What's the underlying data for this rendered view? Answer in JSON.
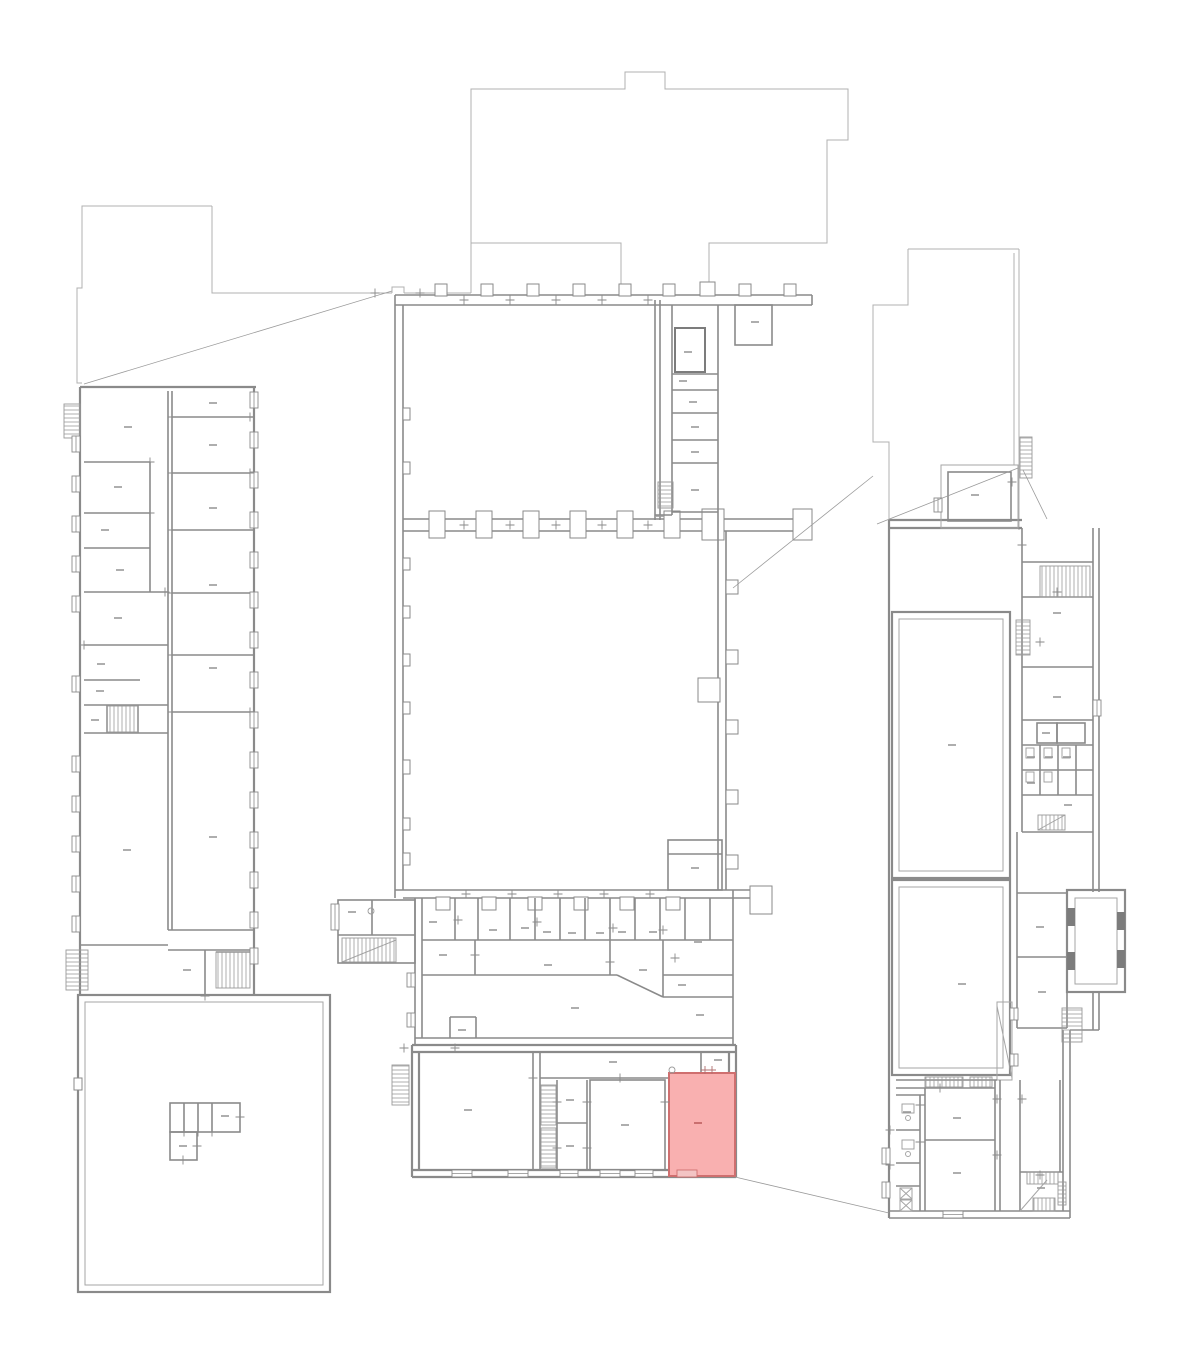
{
  "meta": {
    "drawing_type": "architectural-floor-plan",
    "canvas_width": 1200,
    "canvas_height": 1364
  },
  "palette": {
    "background": "#ffffff",
    "outline_gray": "#b0b0b0",
    "wall_gray": "#8a8a8a",
    "mark_gray": "#9a9a9a",
    "highlight_fill": "#f9b0b0",
    "highlight_stroke": "#cf6f6f",
    "highlight_mark": "#bf5f5f"
  },
  "highlighted_room": {
    "x": 669,
    "y": 1073,
    "width": 66,
    "height": 103,
    "label_mark": {
      "x": 698,
      "y": 1123
    },
    "window": {
      "x": 677,
      "y": 1170,
      "width": 20,
      "height": 7
    }
  },
  "room_label_marks": [
    [
      128,
      427
    ],
    [
      118,
      487
    ],
    [
      105,
      530
    ],
    [
      120,
      570
    ],
    [
      118,
      618
    ],
    [
      101,
      664
    ],
    [
      100,
      691
    ],
    [
      95,
      720
    ],
    [
      127,
      850
    ],
    [
      213,
      403
    ],
    [
      213,
      445
    ],
    [
      213,
      508
    ],
    [
      213,
      585
    ],
    [
      213,
      668
    ],
    [
      213,
      837
    ],
    [
      187,
      970
    ],
    [
      225,
      1116
    ],
    [
      183,
      1146
    ],
    [
      688,
      352
    ],
    [
      683,
      381
    ],
    [
      693,
      402
    ],
    [
      695,
      427
    ],
    [
      695,
      452
    ],
    [
      695,
      490
    ],
    [
      660,
      516
    ],
    [
      755,
      322
    ],
    [
      695,
      868
    ],
    [
      433,
      922
    ],
    [
      493,
      930
    ],
    [
      525,
      928
    ],
    [
      547,
      932
    ],
    [
      572,
      933
    ],
    [
      600,
      933
    ],
    [
      622,
      932
    ],
    [
      653,
      932
    ],
    [
      698,
      942
    ],
    [
      443,
      955
    ],
    [
      548,
      965
    ],
    [
      643,
      970
    ],
    [
      575,
      1008
    ],
    [
      682,
      985
    ],
    [
      700,
      1015
    ],
    [
      462,
      1030
    ],
    [
      352,
      912
    ],
    [
      468,
      1110
    ],
    [
      613,
      1062
    ],
    [
      570,
      1100
    ],
    [
      570,
      1146
    ],
    [
      625,
      1125
    ],
    [
      718,
      1060
    ],
    [
      975,
      495
    ],
    [
      1057,
      613
    ],
    [
      1057,
      697
    ],
    [
      1046,
      733
    ],
    [
      1068,
      805
    ],
    [
      1040,
      927
    ],
    [
      1042,
      992
    ],
    [
      962,
      984
    ],
    [
      952,
      745
    ],
    [
      957,
      1118
    ],
    [
      957,
      1173
    ],
    [
      1041,
      1188
    ],
    [
      907,
      1112
    ],
    [
      1031,
      757
    ],
    [
      1049,
      757
    ],
    [
      1067,
      757
    ],
    [
      1031,
      783
    ]
  ],
  "window_marks_vertical": [
    [
      72,
      436,
      16
    ],
    [
      72,
      476,
      16
    ],
    [
      72,
      516,
      16
    ],
    [
      72,
      556,
      16
    ],
    [
      72,
      596,
      16
    ],
    [
      72,
      676,
      16
    ],
    [
      72,
      756,
      16
    ],
    [
      72,
      796,
      16
    ],
    [
      72,
      836,
      16
    ],
    [
      72,
      876,
      16
    ],
    [
      72,
      916,
      16
    ],
    [
      250,
      392,
      16
    ],
    [
      250,
      432,
      16
    ],
    [
      250,
      472,
      16
    ],
    [
      250,
      512,
      16
    ],
    [
      250,
      552,
      16
    ],
    [
      250,
      592,
      16
    ],
    [
      250,
      632,
      16
    ],
    [
      250,
      672,
      16
    ],
    [
      250,
      712,
      16
    ],
    [
      250,
      752,
      16
    ],
    [
      250,
      792,
      16
    ],
    [
      250,
      832,
      16
    ],
    [
      250,
      872,
      16
    ],
    [
      250,
      912,
      16
    ],
    [
      250,
      948,
      16
    ],
    [
      882,
      1148,
      16
    ],
    [
      882,
      1182,
      16
    ],
    [
      1093,
      700,
      16
    ],
    [
      1010,
      1008,
      12
    ],
    [
      1010,
      1054,
      12
    ],
    [
      331,
      904,
      26
    ],
    [
      407,
      973,
      14
    ],
    [
      407,
      1013,
      14
    ],
    [
      934,
      498,
      14
    ]
  ],
  "window_marks_horizontal": [
    [
      452,
      1170,
      20
    ],
    [
      508,
      1170,
      20
    ],
    [
      560,
      1170,
      18
    ],
    [
      600,
      1170,
      20
    ],
    [
      635,
      1170,
      18
    ],
    [
      943,
      1211,
      20
    ]
  ],
  "stair_hatches": [
    [
      64,
      404,
      16,
      34,
      "h"
    ],
    [
      107,
      706,
      31,
      26,
      "v"
    ],
    [
      66,
      950,
      22,
      40,
      "h"
    ],
    [
      216,
      952,
      34,
      36,
      "v"
    ],
    [
      658,
      482,
      15,
      26,
      "h"
    ],
    [
      342,
      938,
      54,
      24,
      "v"
    ],
    [
      541,
      1085,
      15,
      40,
      "h"
    ],
    [
      541,
      1128,
      15,
      40,
      "h"
    ],
    [
      392,
      1065,
      17,
      40,
      "h"
    ],
    [
      1020,
      437,
      12,
      41,
      "h"
    ],
    [
      1040,
      566,
      50,
      31,
      "v"
    ],
    [
      1016,
      620,
      14,
      35,
      "h"
    ],
    [
      1038,
      815,
      27,
      15,
      "v"
    ],
    [
      1062,
      1008,
      20,
      34,
      "h"
    ],
    [
      925,
      1077,
      38,
      10,
      "v"
    ],
    [
      970,
      1077,
      22,
      10,
      "v"
    ],
    [
      1027,
      1172,
      31,
      12,
      "v"
    ],
    [
      1033,
      1198,
      22,
      13,
      "v"
    ],
    [
      1058,
      1182,
      8,
      23,
      "h"
    ]
  ],
  "door_ticks": [
    [
      375,
      293
    ],
    [
      420,
      293
    ],
    [
      464,
      300
    ],
    [
      510,
      300
    ],
    [
      556,
      300
    ],
    [
      602,
      300
    ],
    [
      648,
      300
    ],
    [
      464,
      525
    ],
    [
      510,
      525
    ],
    [
      556,
      525
    ],
    [
      602,
      525
    ],
    [
      648,
      525
    ],
    [
      466,
      894
    ],
    [
      512,
      894
    ],
    [
      558,
      894
    ],
    [
      604,
      894
    ],
    [
      650,
      894
    ],
    [
      458,
      920
    ],
    [
      537,
      922
    ],
    [
      613,
      928
    ],
    [
      663,
      930
    ],
    [
      475,
      955
    ],
    [
      610,
      962
    ],
    [
      675,
      958
    ],
    [
      533,
      1078
    ],
    [
      557,
      1102
    ],
    [
      587,
      1102
    ],
    [
      557,
      1148
    ],
    [
      587,
      1148
    ],
    [
      620,
      1078
    ],
    [
      665,
      1102
    ],
    [
      940,
      1088
    ],
    [
      997,
      1099
    ],
    [
      997,
      1155
    ],
    [
      920,
      1105
    ],
    [
      920,
      1142
    ],
    [
      890,
      1130
    ],
    [
      890,
      1165
    ],
    [
      1022,
      1099
    ],
    [
      1040,
      1175
    ],
    [
      1022,
      545
    ],
    [
      1057,
      592
    ],
    [
      1040,
      642
    ],
    [
      1012,
      482
    ],
    [
      150,
      462
    ],
    [
      150,
      513
    ],
    [
      165,
      592
    ],
    [
      84,
      645
    ],
    [
      172,
      417
    ],
    [
      250,
      417
    ],
    [
      172,
      473
    ],
    [
      250,
      473
    ],
    [
      172,
      530
    ],
    [
      172,
      593
    ],
    [
      172,
      655
    ],
    [
      250,
      712
    ],
    [
      172,
      712
    ],
    [
      184,
      1132
    ],
    [
      198,
      1132
    ],
    [
      212,
      1132
    ],
    [
      240,
      1117
    ],
    [
      197,
      1146
    ],
    [
      183,
      1160
    ],
    [
      205,
      996
    ],
    [
      404,
      1048
    ],
    [
      455,
      1048
    ]
  ],
  "highlight_ticks": [
    [
      705,
      1070
    ],
    [
      712,
      1070
    ]
  ],
  "leader_lines": [
    [
      84,
      384,
      392,
      291
    ],
    [
      733,
      588,
      873,
      476
    ],
    [
      877,
      524,
      1018,
      468
    ],
    [
      1023,
      470,
      1047,
      519
    ],
    [
      735,
      1177,
      889,
      1213
    ]
  ],
  "door_circles": [
    [
      371,
      911
    ],
    [
      672,
      1070
    ]
  ]
}
